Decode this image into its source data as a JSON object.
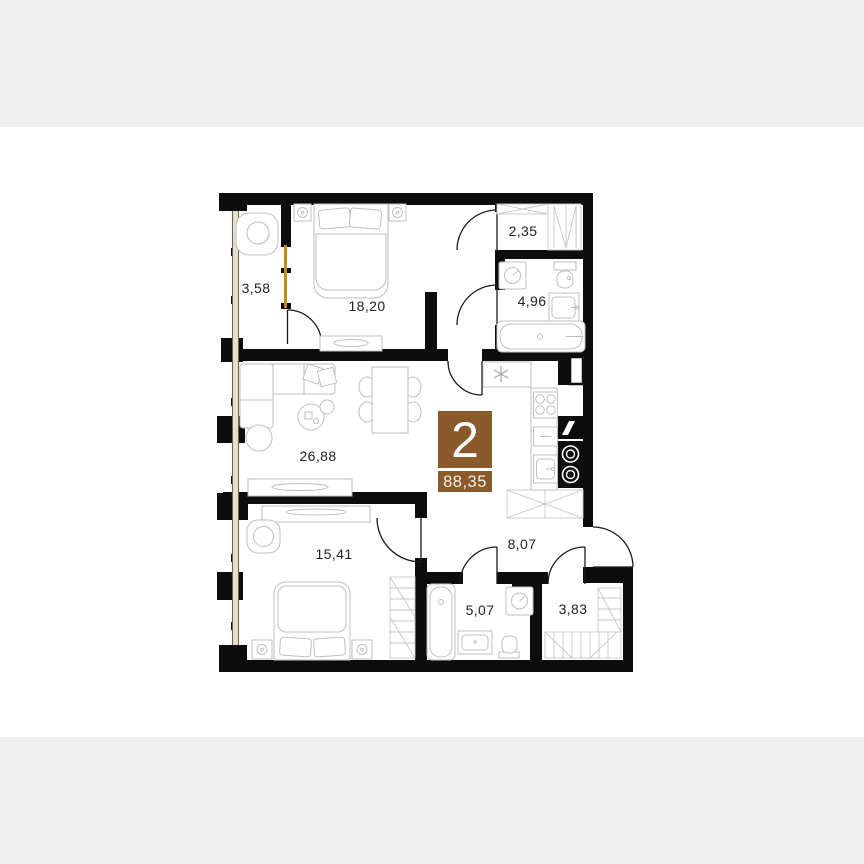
{
  "page": {
    "background": "#ffffff",
    "band_color": "#f0f0f0"
  },
  "plan": {
    "badge": {
      "rooms_count": "2",
      "total_area": "88,35",
      "color": "#8a5a2b",
      "number_color": "#ffffff",
      "area_text_color": "#f5efe2"
    },
    "rooms": [
      {
        "id": "balcony",
        "area": "3,58"
      },
      {
        "id": "bedroom-master",
        "area": "18,20"
      },
      {
        "id": "walk-in-closet",
        "area": "2,35"
      },
      {
        "id": "bathroom-master",
        "area": "4,96"
      },
      {
        "id": "living-kitchen",
        "area": "26,88"
      },
      {
        "id": "bedroom-second",
        "area": "15,41"
      },
      {
        "id": "hallway",
        "area": "8,07"
      },
      {
        "id": "bathroom",
        "area": "5,07"
      },
      {
        "id": "closet",
        "area": "3,83"
      }
    ],
    "colors": {
      "wall": "#0d0d0d",
      "furniture": "#bfbfbf",
      "window_accent": "#c08536",
      "window_fill": "#e8dfc9",
      "label": "#222222"
    }
  }
}
